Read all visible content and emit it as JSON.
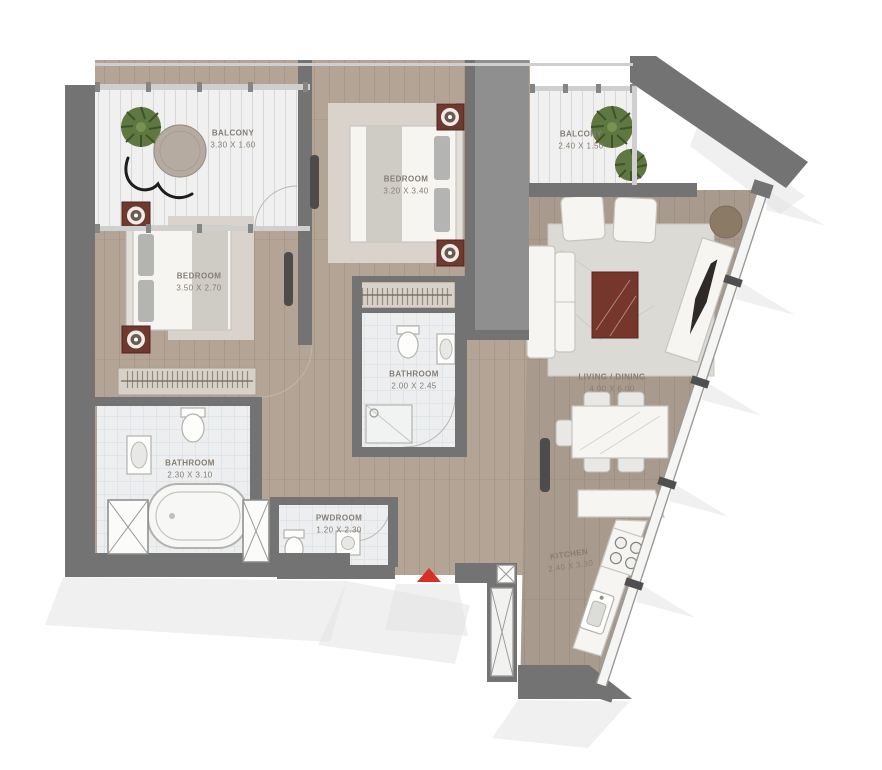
{
  "meta": {
    "type": "apartment floor plan",
    "description": "2-bedroom apartment floor plan with two balconies, living/dining, kitchen and angled window wall"
  },
  "rooms": [
    {
      "id": "balcony-1",
      "name": "BALCONY",
      "dims": "3.30 X 1.60"
    },
    {
      "id": "bedroom-1",
      "name": "BEDROOM",
      "dims": "3.50 X 2.70"
    },
    {
      "id": "bedroom-2",
      "name": "BEDROOM",
      "dims": "3.20 X 3.40"
    },
    {
      "id": "balcony-2",
      "name": "BALCONY",
      "dims": "2.40 X 1.50"
    },
    {
      "id": "bathroom-1",
      "name": "BATHROOM",
      "dims": "2.30 X 3.10"
    },
    {
      "id": "bathroom-2",
      "name": "BATHROOM",
      "dims": "2.00 X 2.45"
    },
    {
      "id": "powder-room",
      "name": "PWDROOM",
      "dims": "1.20 X 2.30"
    },
    {
      "id": "living-dining",
      "name": "LIVING / DINING",
      "dims": "4.00 X 6.00"
    },
    {
      "id": "kitchen",
      "name": "KITCHEN",
      "dims": "2.40 X 3.30"
    }
  ],
  "colors": {
    "wall": "#737373",
    "wall_light": "#8f8f8f",
    "wood_bedroom": "#b3a496",
    "wood_living": "#a89b8d",
    "balcony_floor": "#f0f0f0",
    "tile_floor": "#eceef0",
    "rug": "#d9d3cb",
    "rug_living": "#dcdad5",
    "bed_white": "#f6f5f2",
    "maroon": "#6e392f",
    "coffee_table": "#76362c",
    "accent_red": "#d93025",
    "plant_green": "#5f7842",
    "glass_frame": "#9a9a9a",
    "mullion": "#4f4f4f",
    "label_text": "#867d73",
    "table_brown": "#8b7b66",
    "shadow": "#e4e4e4"
  }
}
